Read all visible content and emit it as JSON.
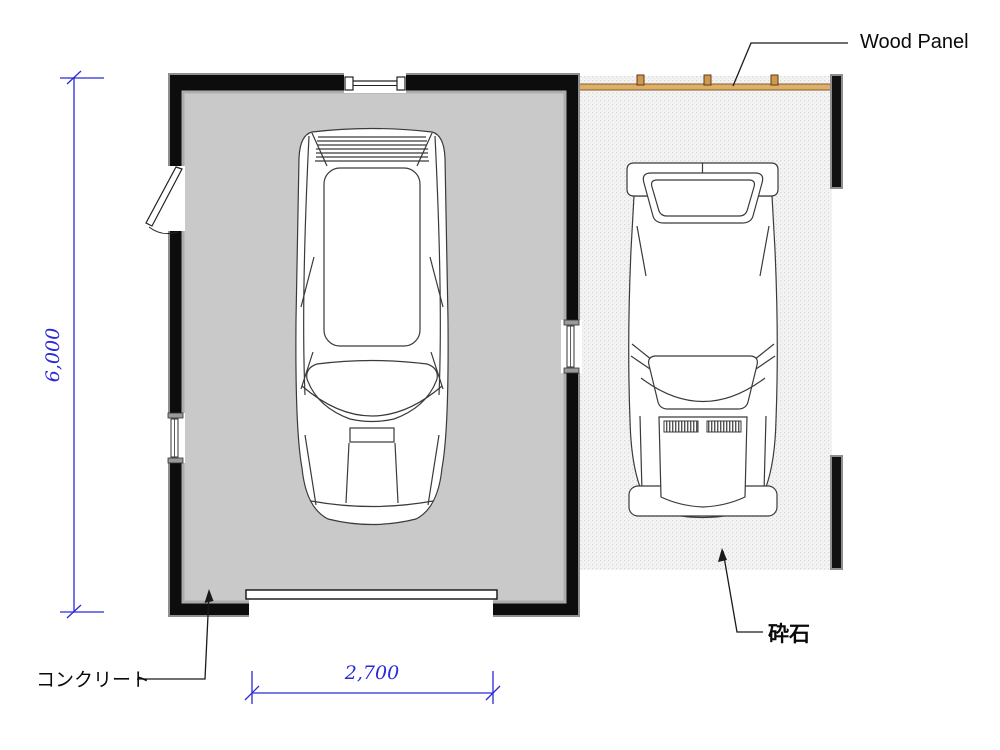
{
  "drawing": {
    "labels": {
      "wood_panel": "Wood Panel",
      "concrete": "コンクリート",
      "gravel": "砕石"
    },
    "dimensions": {
      "height_mm": "6,000",
      "width_mm": "2,700"
    },
    "colors": {
      "dimension_blue": "#2a2ad6",
      "wall_black": "#0d0d0d",
      "wall_edge_gray": "#8f8f8f",
      "floor_gray": "#c9c9c9",
      "gravel_base": "#f4f4f4",
      "gravel_dot": "#d8d8d8",
      "wood_panel_fill": "#dcb06a",
      "wood_panel_border": "#8a5a23",
      "wood_post_fill": "#cf9750",
      "vehicle_line": "#3a3a3a"
    }
  }
}
